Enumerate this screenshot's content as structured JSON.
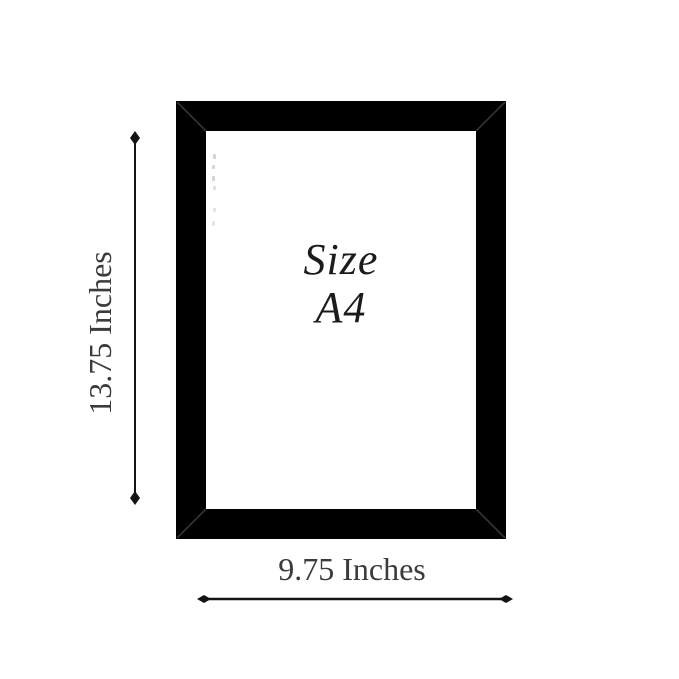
{
  "frame": {
    "label_line1": "Size",
    "label_line2": "A4",
    "frame_color": "#000000",
    "miter_line_color": "#343434",
    "mat_color": "#ffffff"
  },
  "dimensions": {
    "height_label": "13.75 Inches",
    "width_label": "9.75 Inches",
    "arrow_color": "#141414",
    "label_color": "#3b3b3b"
  }
}
